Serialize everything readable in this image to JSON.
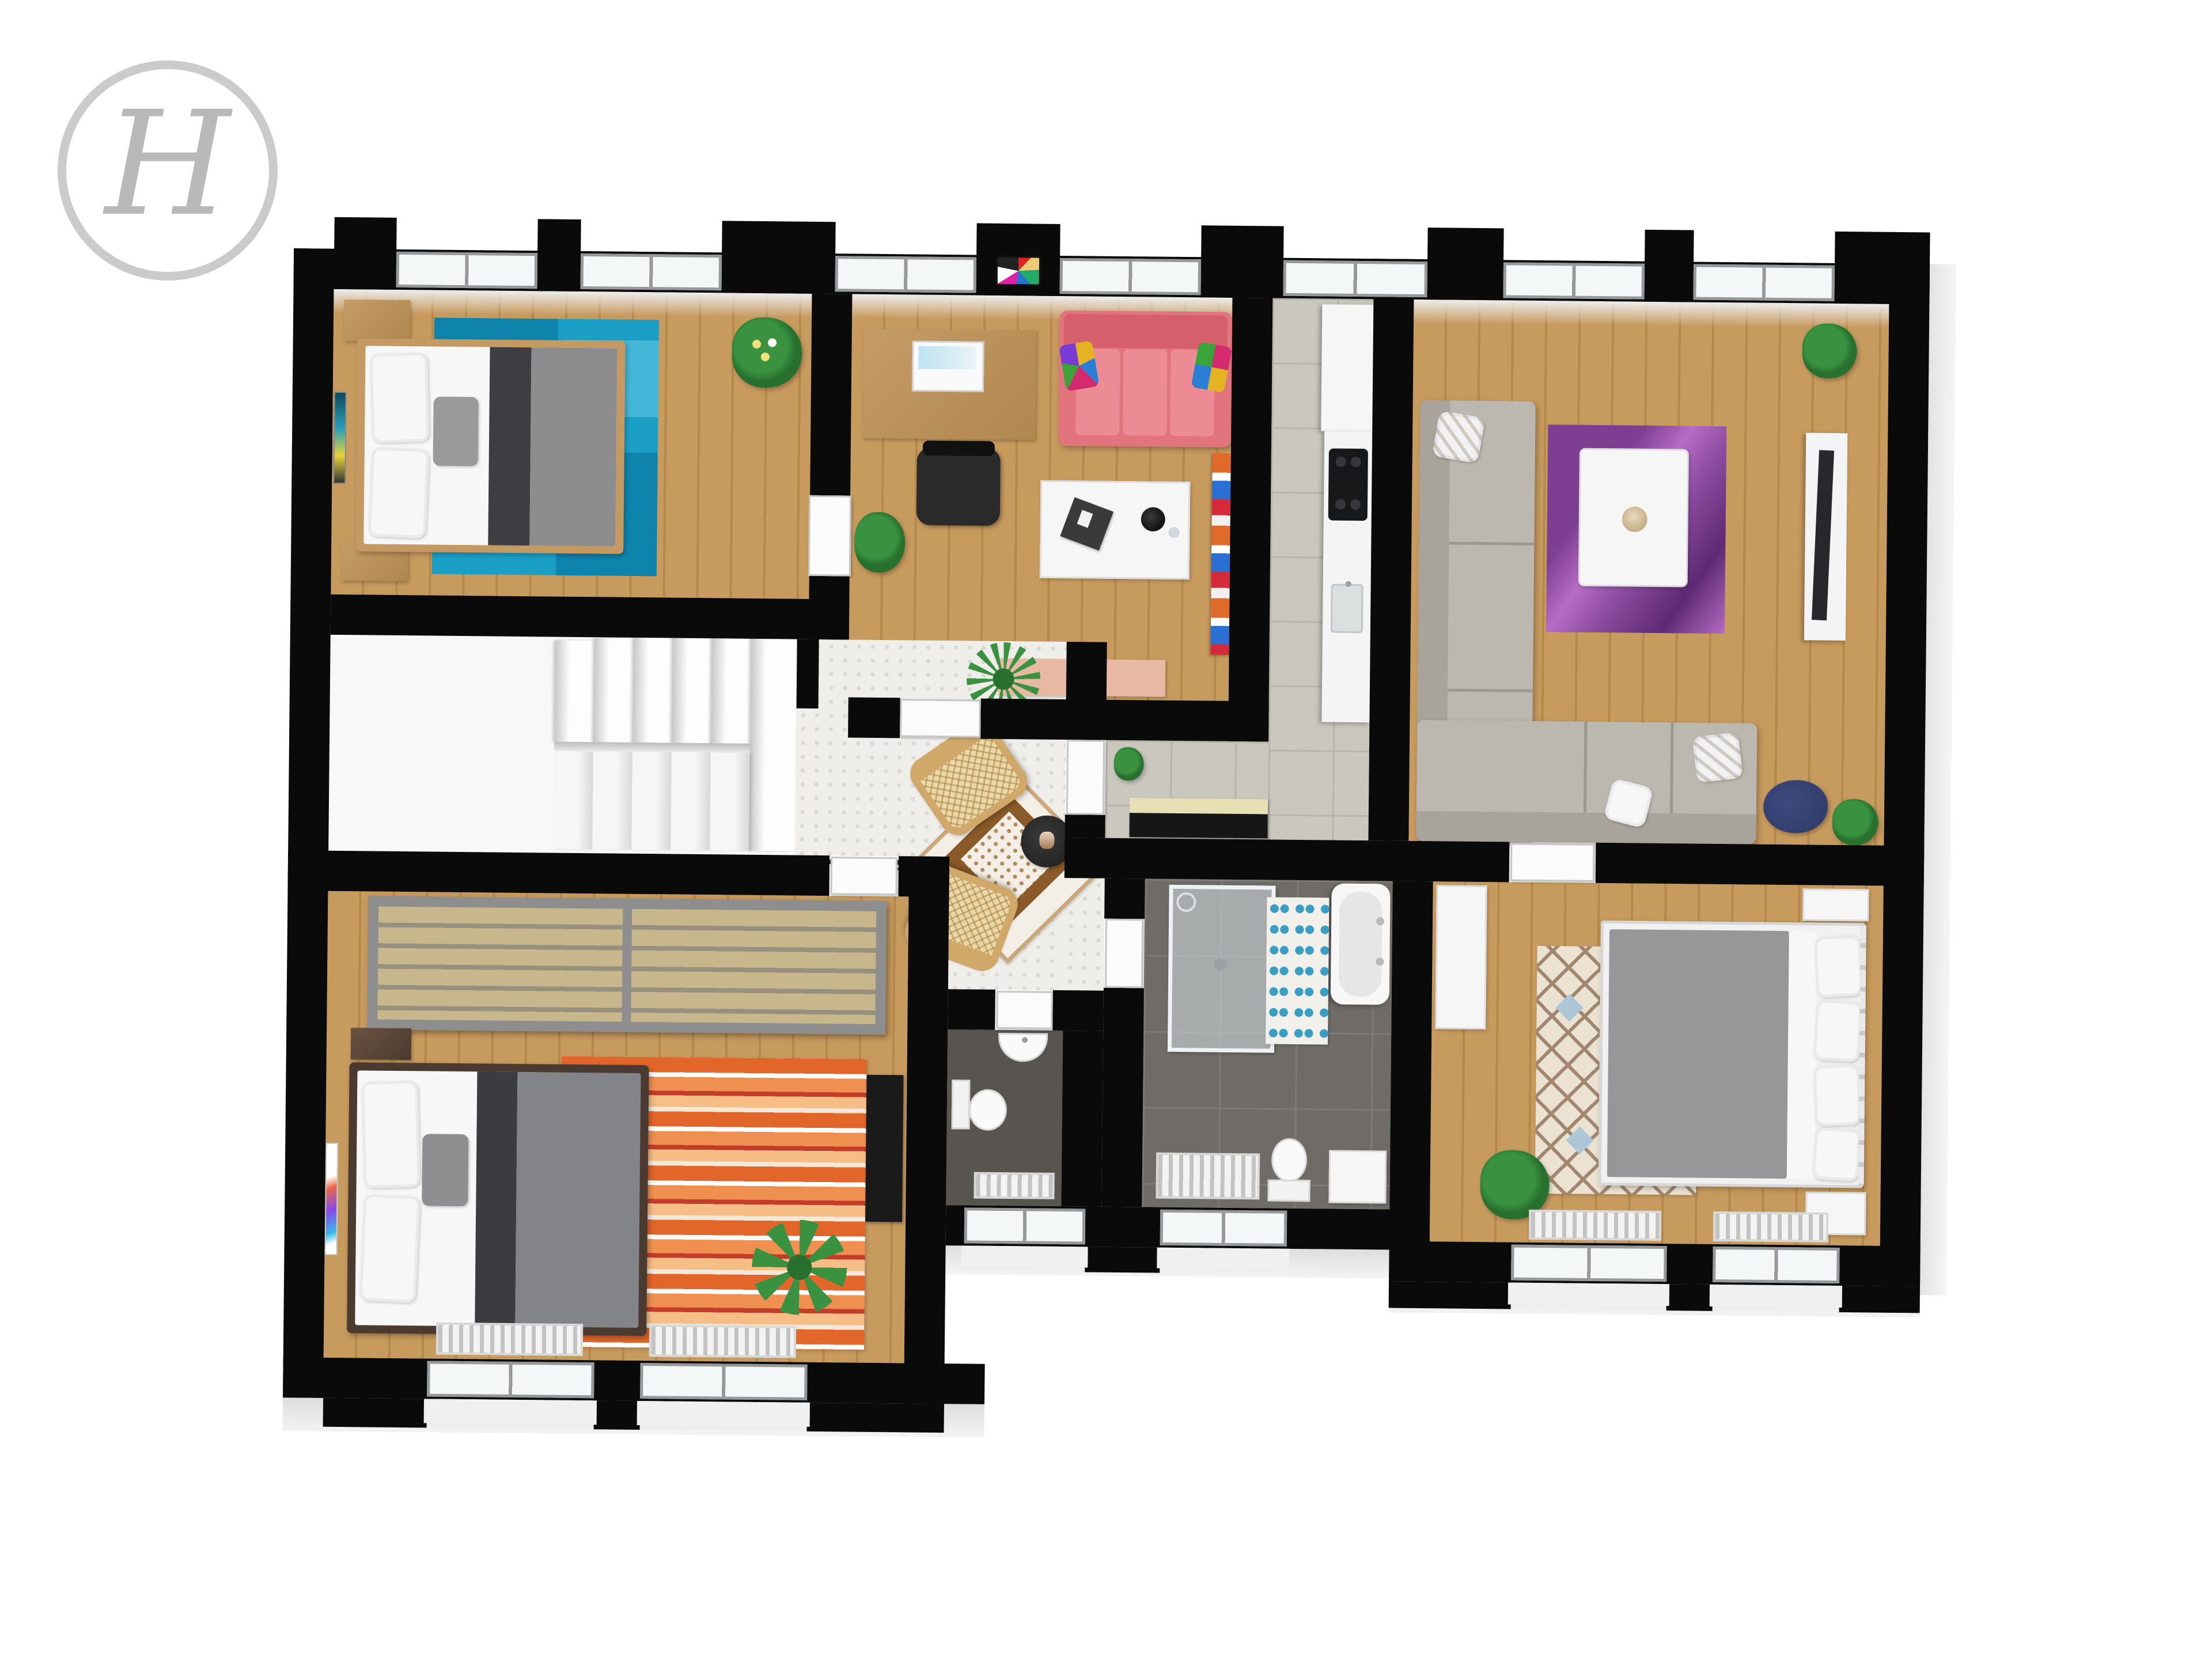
{
  "logo": {
    "letter": "H"
  },
  "plan": {
    "type": "3d-floorplan-top-down-render",
    "description": "Rendered top view of an apartment floor with black walls, white recessed windows and furnished rooms",
    "rooms": [
      {
        "name": "bedroom-top-left",
        "floor": "wood",
        "furniture": [
          "double-bed-wood-frame",
          "gray-duvet",
          "white-pillows",
          "teal-patchwork-rug",
          "two-wood-nightstands",
          "flower-plant",
          "wall-art",
          "two-top-windows"
        ]
      },
      {
        "name": "office-lounge",
        "floor": "wood",
        "furniture": [
          "desk-with-laptop",
          "office-chair",
          "pink-three-seat-sofa",
          "colorful-cushions",
          "white-coffee-table-with-tea-set",
          "salmon-sideboard",
          "bookshelf",
          "plant",
          "tv-test-card-on-wall"
        ]
      },
      {
        "name": "kitchen",
        "floor": "gray-tile",
        "furniture": [
          "tall-white-cabinet",
          "counter-with-black-cooktop",
          "sink",
          "cream-black-bench"
        ]
      },
      {
        "name": "living-room",
        "floor": "wood",
        "furniture": [
          "gray-corner-sofa",
          "white-pattern-pillows",
          "white-coffee-table",
          "purple-swirl-rug",
          "tv-on-white-stand",
          "blue-painting",
          "small-plant",
          "navy-beanbag"
        ]
      },
      {
        "name": "hallway",
        "floor": "hexagon-tile",
        "furniture": [
          "two-rattan-armchairs",
          "black-round-side-table",
          "ornamental-diamond-rug",
          "fern-plant",
          "potted-plant",
          "coat-hooks"
        ]
      },
      {
        "name": "staircase",
        "floor": "white",
        "furniture": [
          "u-shaped-white-stairs",
          "landing"
        ]
      },
      {
        "name": "wc",
        "floor": "dark-tile",
        "furniture": [
          "toilet",
          "wall-sink",
          "radiator"
        ]
      },
      {
        "name": "bathroom",
        "floor": "dark-gray-tile",
        "furniture": [
          "walk-in-glass-shower",
          "bathtub-two-faucets",
          "blue-petal-rug",
          "towel-radiator",
          "toilet",
          "white-cabinet"
        ]
      },
      {
        "name": "bedroom-bottom-left",
        "floor": "wood",
        "furniture": [
          "gray-sliding-wardrobe",
          "double-bed-dark-frame",
          "orange-striped-rug",
          "monstera-plant",
          "dark-tv-dresser",
          "wall-art",
          "wood-nightstand",
          "two-bottom-windows"
        ]
      },
      {
        "name": "bedroom-bottom-right",
        "floor": "wood",
        "furniture": [
          "white-metal-frame-bed",
          "gray-duvet",
          "four-white-pillows",
          "diamond-lattice-rug",
          "white-wardrobe",
          "white-nightstands",
          "plant",
          "two-bottom-windows"
        ]
      }
    ],
    "colors": {
      "wall": "#0a0a0a",
      "wood": "#c79a5e",
      "woodline": "#b5894c",
      "tile": "#cac7be",
      "tileline": "#b8b5ab",
      "hex": "#efeeea",
      "hexdot": "#dbdad3",
      "bathfloor": "#6f6b66",
      "bathline": "#7d7974",
      "wcfloor": "#585450",
      "teal": "#1b9fc7",
      "tealdark": "#0e84ad",
      "teallight": "#44b7d8",
      "teallighter": "#95d5e7",
      "pink": "#e2747e",
      "pinkdark": "#d55f6b",
      "pinkseat": "#ec8b93",
      "sofagray": "#bcb7af",
      "sofagraydark": "#a8a39b",
      "duvet": "#8d8d90",
      "duvetdark": "#3d3d42",
      "mattress": "#f7f7f7",
      "bedwood": "#c49a62",
      "beddark": "#4b3a30",
      "stair": "#fbfbfb",
      "stairedge": "#cccccc",
      "wardrobe": "#8e8e8e",
      "wardrobeslat": "#c8b68c",
      "wardrobeslatdark": "#96907d",
      "orange1": "#e2662a",
      "orange2": "#f09050",
      "orange3": "#c43d2a",
      "orange4": "#f7bd86",
      "rug3": "#ebe2d1",
      "rug3line": "#a08870",
      "rug3blue": "#aec7d8",
      "rug3orange": "#e09a54",
      "purple1": "#7e3f92",
      "purple2": "#b66cc4",
      "hallrug": "#f4efe6",
      "hallrugborder": "#8a5a28",
      "hallrugtrim": "#caa87c",
      "plant": "#3a9140",
      "plantdark": "#27702e",
      "desk": "#b88b52",
      "tv": "#26282c",
      "benchcream": "#e7e0b5",
      "benchblack": "#161616",
      "doorcol": "#fbfbfb",
      "winframe": "#97989a",
      "winglass": "#f4f7f8",
      "metal": "#b9b9b9",
      "navy": "#2e3a66",
      "salmon": "#e8b9a2",
      "logocircle": "#cbcbcb",
      "logoletter": "#b9b9b9"
    }
  }
}
